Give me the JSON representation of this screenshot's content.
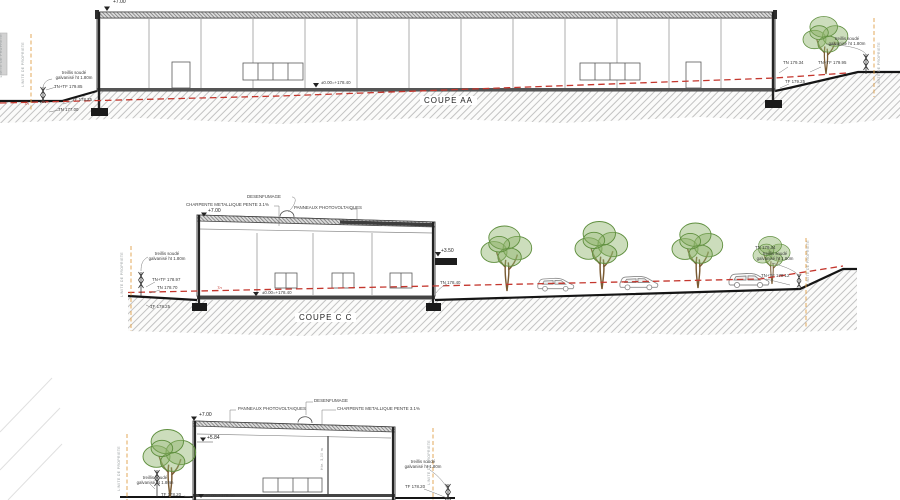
{
  "colors": {
    "red_dashed": "#c4372e",
    "orange_property_line": "#e0a04a",
    "earth_hatch": "#b4b4b4",
    "tree_green": "#5f8f3e",
    "line_dark": "#3c3c3c"
  },
  "sections": {
    "aa": {
      "title": "COUPE AA",
      "level_top": "+7.00",
      "level_zero": "±0.00=+178.40",
      "tn_small": "Tn",
      "edge_limit": "LIMITE DE PROPRETE",
      "left": {
        "limit": "LIMITE DE PROPRIETE",
        "fence": "treillis soudé\ngalvanisé ht 1.80m",
        "tn_tf": "TN+TF 179.85",
        "tf": "TF 178.25",
        "tn": "TN 177.00"
      },
      "right": {
        "tn": "TN 179.34",
        "tn_tf": "TN+TF 179.95",
        "tf": "TF 179.25",
        "fence": "treillis soudé\ngalvanisé ht 1.80m",
        "limit": "LIMITE DE PROPRIETE"
      }
    },
    "cc": {
      "title": "COUPE C C",
      "level_top": "+7.00",
      "level_canopy": "+3.50",
      "level_zero": "±0.00=+178.40",
      "tn_small": "Tn",
      "tn_ground": "TN 178.40",
      "labels": {
        "desenfumage": "DESENFUMAGE",
        "charpente": "CHARPENTE METALLIQUE PENTE 3.1%",
        "panneaux": "PANNEAUX PHOTOVOLTAIQUES"
      },
      "left": {
        "limit": "LIMITE DE PROPRIETE",
        "fence": "treillis soudé\ngalvanisé ht 1.80m",
        "tn_tf": "TN+TF 178.97",
        "tn": "TN 178.70",
        "tf": "TF 178.25"
      },
      "right": {
        "tn": "TN 179.34",
        "fence": "treillis soudé\ngalvanisé ht 1.80m",
        "tn_tf": "TN+TF 179.12",
        "limit": "LIMITE DE PROPRIETE"
      }
    },
    "b": {
      "level_top": "+7.00",
      "level_mid": "+5.84",
      "level_zero": "±0.00=+178.40",
      "interior_height": "Hte. 3,00 m",
      "labels": {
        "desenfumage": "DESENFUMAGE",
        "charpente": "CHARPENTE METALLIQUE PENTE 3.1%",
        "panneaux": "PANNEAUX PHOTOVOLTAIQUES"
      },
      "left": {
        "limit": "LIMITE DE PROPRIETE",
        "fence": "treillis soudé\ngalvanisé ht 1.80m",
        "tf": "TF 178.20"
      },
      "right": {
        "fence": "treillis soudé\ngalvanisé ht 1.80m",
        "tf": "TF 178.20",
        "limit": "LIMITE DE PROPRIETE"
      }
    }
  }
}
